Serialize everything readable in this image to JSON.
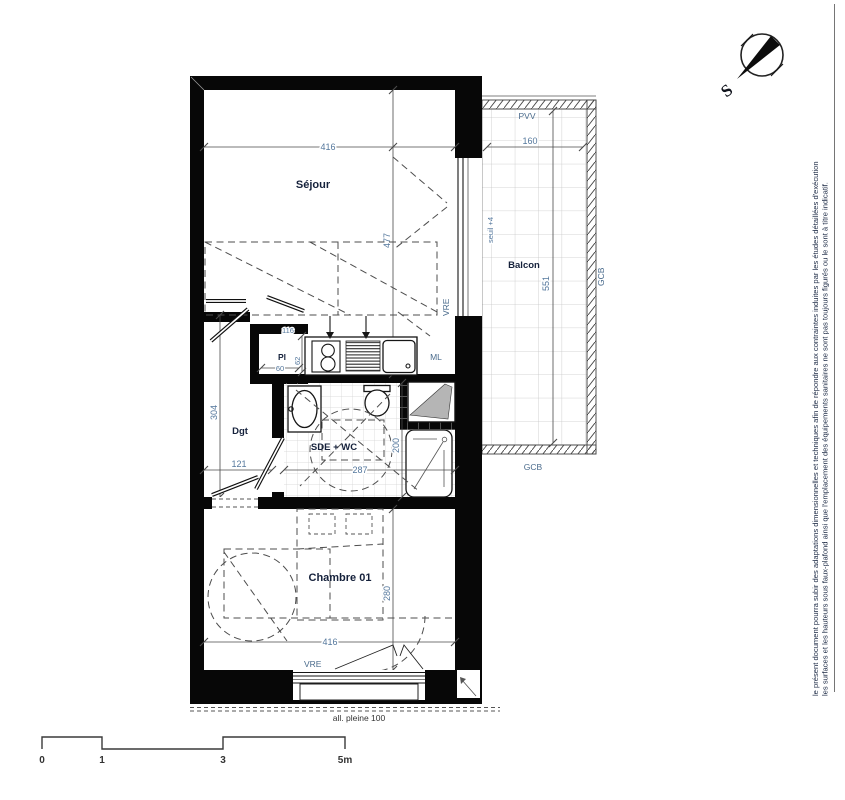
{
  "disclaimer": {
    "line1": "le présent document pourra subir des adaptations dimensionnelles et techniques afin de répondre aux contraintes induites par les études détaillées d'exécution",
    "line2": "les surfaces et les hauteurs sous faux-plafond ainsi que l'emplacement des équipements sanitaires ne sont pas toujours figurés ou le sont à titre indicatif."
  },
  "compass": {
    "south": "S"
  },
  "rooms": {
    "sejour": {
      "name": "Séjour",
      "width": "416",
      "depth": "477"
    },
    "balcon": {
      "name": "Balcon",
      "width": "160",
      "depth": "551",
      "seuil": "seuil +4",
      "rail_top": "PVV",
      "rail_right": "GCB",
      "rail_bottom": "GCB"
    },
    "dgt": {
      "name": "Dgt",
      "depth": "304",
      "width": "121"
    },
    "pl": {
      "name": "Pl",
      "depth": "62",
      "width": "60",
      "top_dim": "116"
    },
    "sde": {
      "name": "SDE + WC",
      "width": "287",
      "shower_depth": "200"
    },
    "chambre": {
      "name": "Chambre 01",
      "depth": "280",
      "width": "416"
    }
  },
  "labels": {
    "ml": "ML",
    "vre_sejour": "VRE",
    "vre_chambre": "VRE",
    "allege": "all. pleine 100"
  },
  "scale": {
    "t0": "0",
    "t1": "1",
    "t3": "3",
    "t5": "5m"
  },
  "colors": {
    "wall": "#070707",
    "dim_text": "#54779c",
    "room_text": "#15213b"
  }
}
